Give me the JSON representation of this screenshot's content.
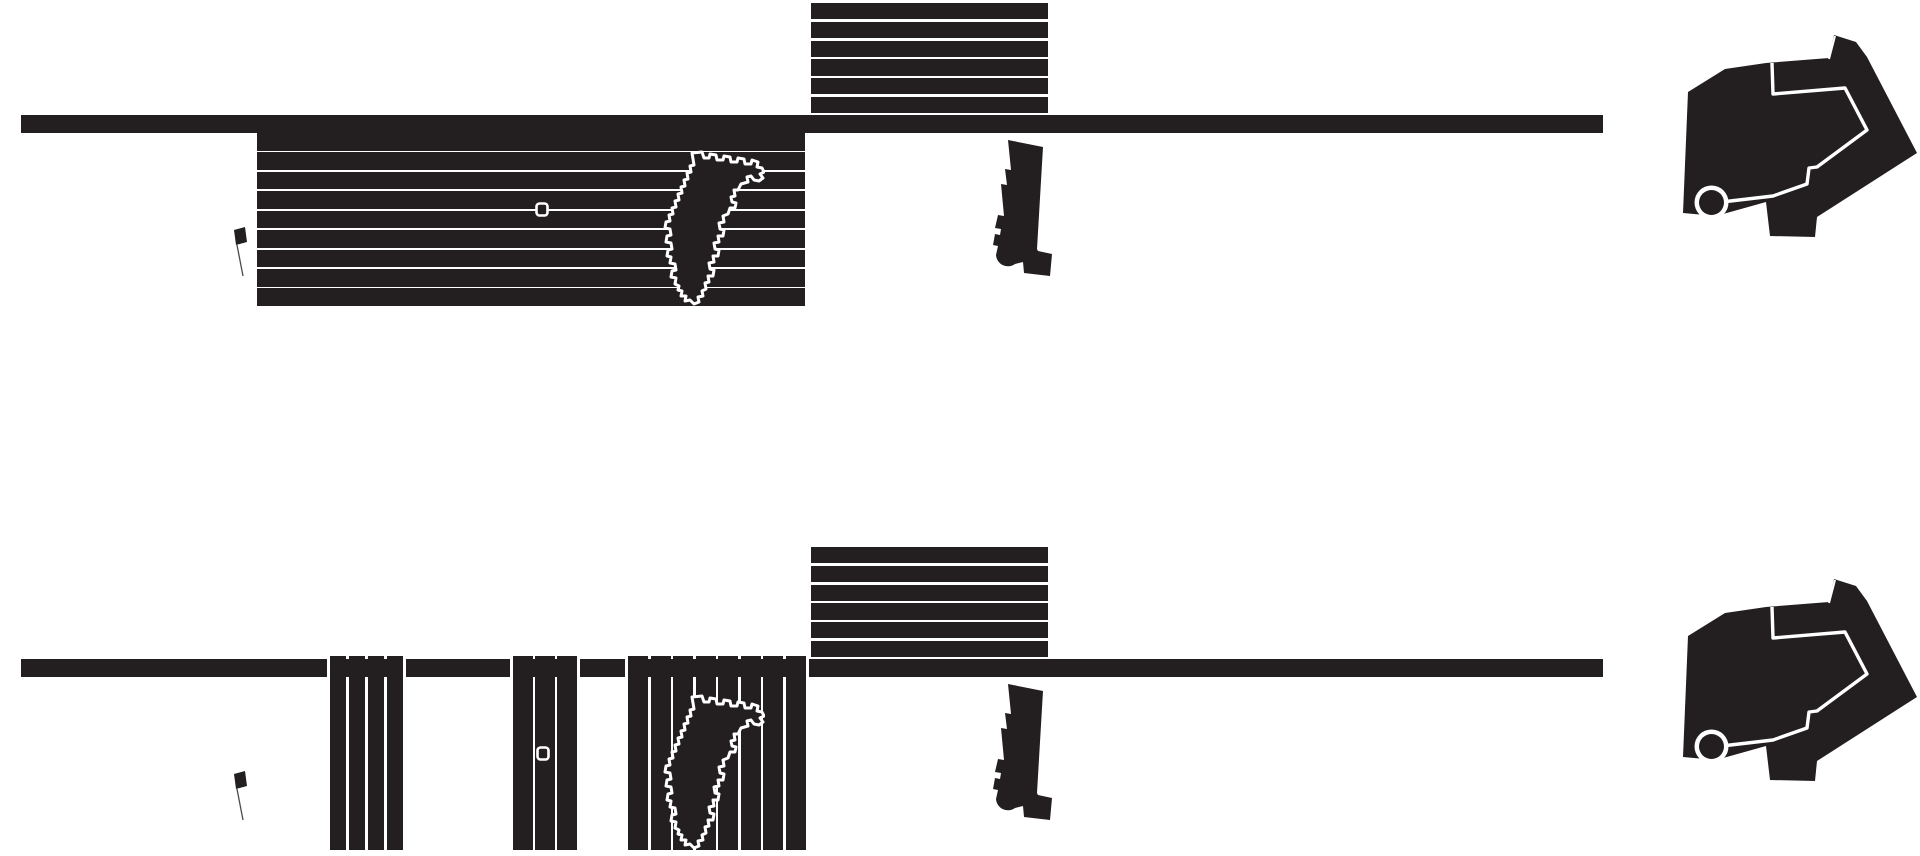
{
  "colors": {
    "ink": "#231f20",
    "background": "#ffffff",
    "stripe_gap": "#ffffff",
    "plan_outline": "#ffffff",
    "flag_pole": "#4a4a4a"
  },
  "rows": [
    {
      "label": "variant-a",
      "upper_band_stripes": 6,
      "hatched_block_stripes": 9
    },
    {
      "label": "variant-b",
      "upper_band_stripes": 6,
      "pier_blocks": [
        {
          "stripes": 4
        },
        {
          "stripes": 3
        },
        {
          "stripes": 8
        }
      ],
      "road_gap_count": 6
    }
  ]
}
